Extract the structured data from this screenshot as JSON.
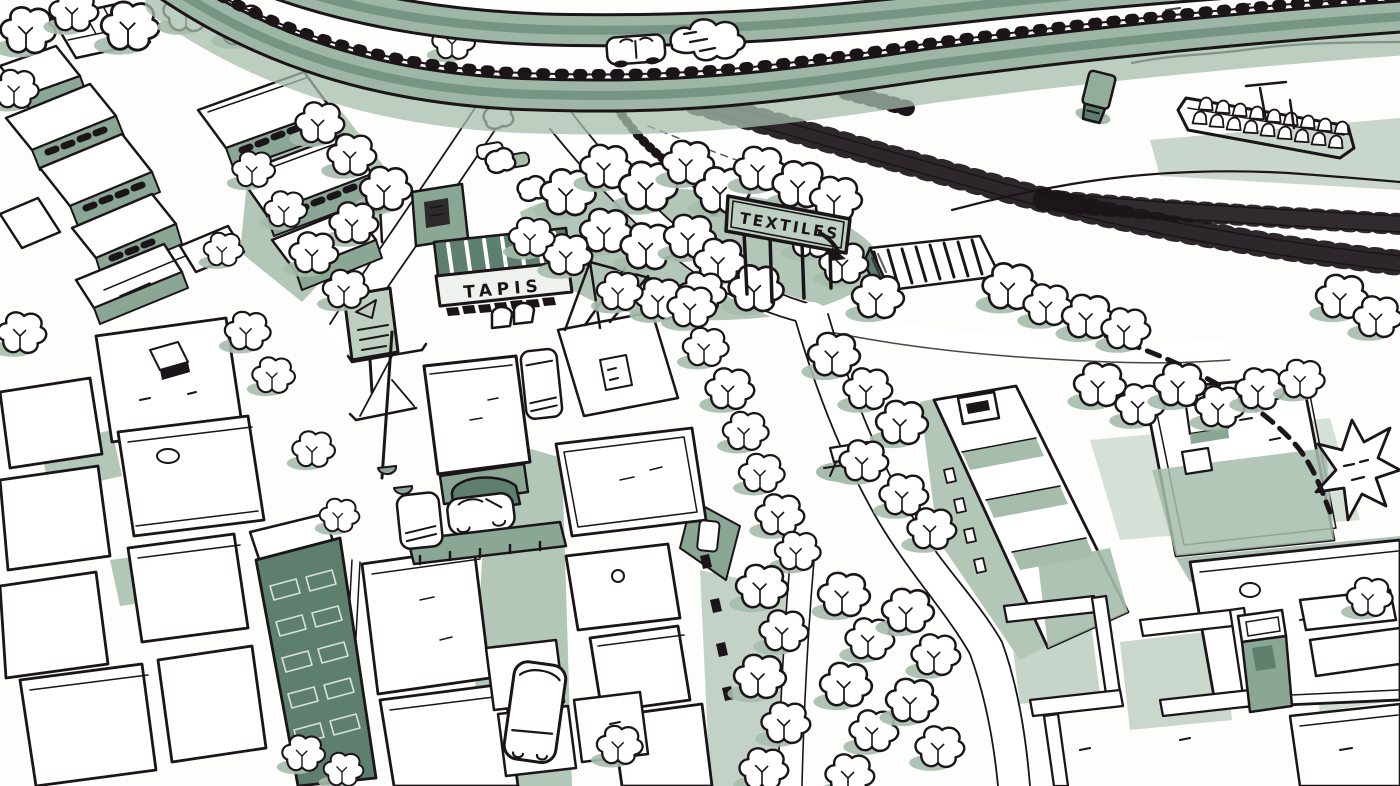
{
  "palette": {
    "paper": "#fdfdfb",
    "ink": "#1b1418",
    "wash": "#a6bdac",
    "wash2": "#8aa695",
    "wash3": "#5e7f6e",
    "board": "#bccfc0"
  },
  "signs": {
    "billboard_text": "TEXTILES",
    "shop_sign": "TAPIS"
  }
}
